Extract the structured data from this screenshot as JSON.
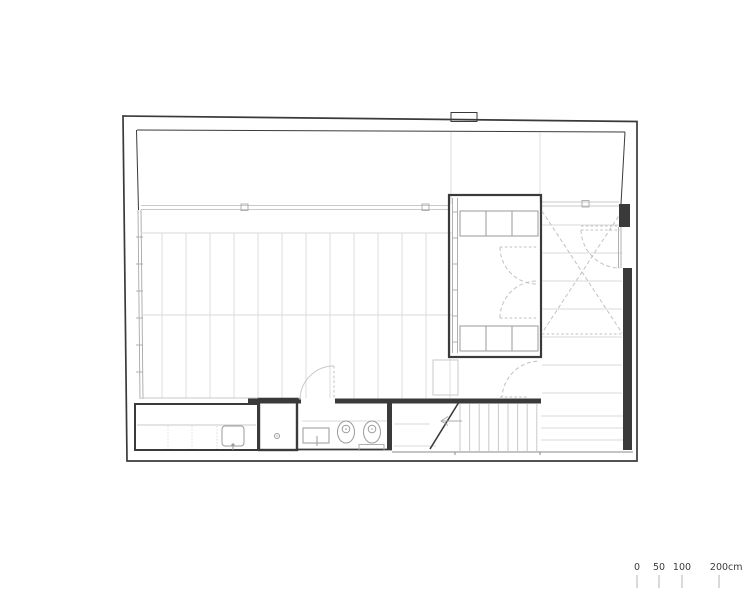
{
  "drawing": {
    "kind": "architectural-floor-plan",
    "visible_text_note": "only text rendered in the image is the scale bar"
  },
  "scale_bar": {
    "ticks": [
      {
        "label": "0"
      },
      {
        "label": "50"
      },
      {
        "label": "100"
      },
      {
        "label": "200"
      }
    ],
    "unit": "cm"
  },
  "colors": {
    "background": "#ffffff",
    "wall": "#3a3a3a",
    "line_light": "#c9c9c9",
    "line_lighter": "#dadada",
    "line_mid": "#a8a8a8",
    "fixture": "#9a9a9a",
    "dashed": "#c2c2c2",
    "text": "#3c3c3c"
  }
}
